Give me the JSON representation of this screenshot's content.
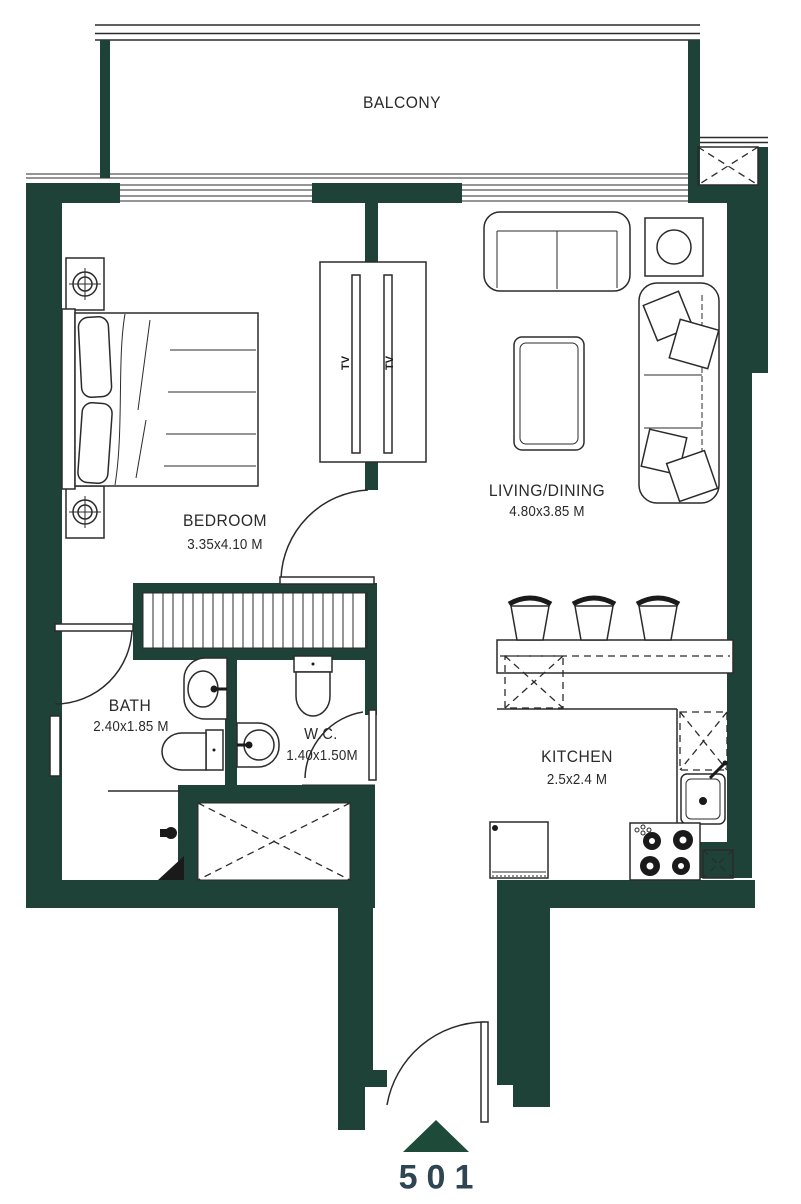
{
  "floorplan": {
    "unit": {
      "number": "501"
    },
    "rooms": [
      {
        "id": "balcony",
        "name": "BALCONY",
        "dims": ""
      },
      {
        "id": "bedroom",
        "name": "BEDROOM",
        "dims": "3.35x4.10 M"
      },
      {
        "id": "living_dining",
        "name": "LIVING/DINING",
        "dims": "4.80x3.85 M"
      },
      {
        "id": "bath",
        "name": "BATH",
        "dims": "2.40x1.85 M"
      },
      {
        "id": "wc",
        "name": "W.C.",
        "dims": "1.40x1.50M"
      },
      {
        "id": "kitchen",
        "name": "KITCHEN",
        "dims": "2.5x2.4 M"
      }
    ],
    "fixtures": {
      "tv_label": "TV"
    },
    "colors": {
      "wall": "#1f4238",
      "line": "#2b2b2b",
      "unit_text": "#2e4653",
      "entry_marker": "#1d4a39",
      "background": "#ffffff"
    }
  }
}
